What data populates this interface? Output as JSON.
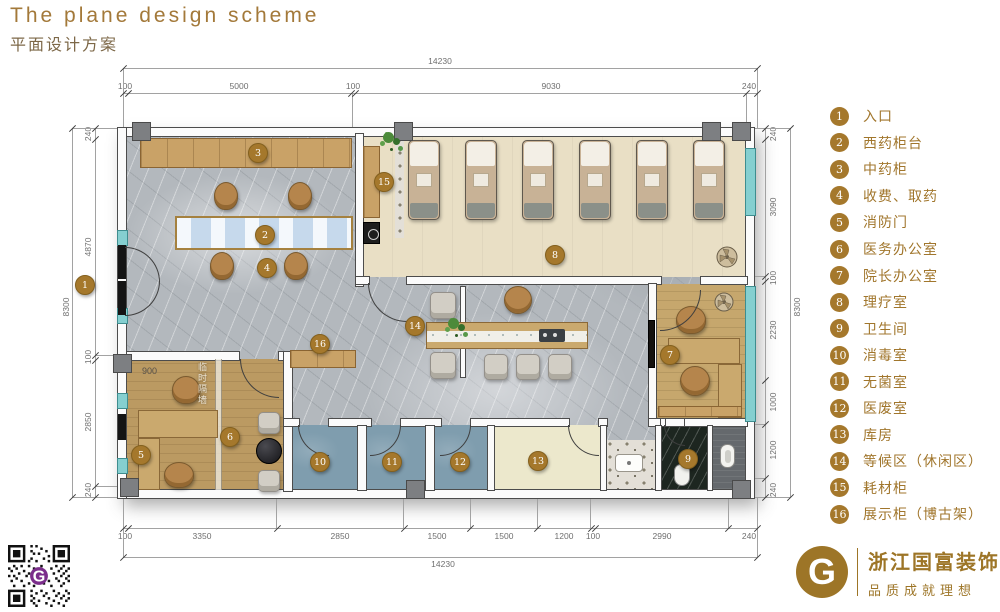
{
  "title": {
    "en": "The plane design scheme",
    "zh": "平面设计方案"
  },
  "legend": {
    "items": [
      {
        "num": "1",
        "label": "入口"
      },
      {
        "num": "2",
        "label": "西药柜台"
      },
      {
        "num": "3",
        "label": "中药柜"
      },
      {
        "num": "4",
        "label": "收费、取药"
      },
      {
        "num": "5",
        "label": "消防门"
      },
      {
        "num": "6",
        "label": "医务办公室"
      },
      {
        "num": "7",
        "label": "院长办公室"
      },
      {
        "num": "8",
        "label": "理疗室"
      },
      {
        "num": "9",
        "label": "卫生间"
      },
      {
        "num": "10",
        "label": "消毒室"
      },
      {
        "num": "11",
        "label": "无菌室"
      },
      {
        "num": "12",
        "label": "医废室"
      },
      {
        "num": "13",
        "label": "库房"
      },
      {
        "num": "14",
        "label": "等候区（休闲区）"
      },
      {
        "num": "15",
        "label": "耗材柜"
      },
      {
        "num": "16",
        "label": "展示柜（博古架）"
      }
    ]
  },
  "dims": {
    "top": {
      "overall": "14230",
      "s": [
        "100",
        "5000",
        "100",
        "9030",
        "240"
      ]
    },
    "bottom": {
      "overall": "14230",
      "s": [
        "100",
        "3350",
        "2850",
        "1500",
        "1500",
        "1200",
        "100",
        "2990",
        "240"
      ]
    },
    "left": {
      "overall": "8300",
      "s": [
        "240",
        "4870",
        "100",
        "2850",
        "240"
      ]
    },
    "right": {
      "overall": "8300",
      "s": [
        "240",
        "3090",
        "100",
        "2230",
        "1000",
        "1200",
        "240"
      ]
    }
  },
  "plan": {
    "markers": [
      "1",
      "2",
      "3",
      "4",
      "5",
      "6",
      "7",
      "8",
      "9",
      "10",
      "11",
      "12",
      "13",
      "14",
      "15",
      "16"
    ],
    "partition_width": "900",
    "partition_label": "临时隔墙"
  },
  "branding": {
    "logo_letter": "G",
    "company": "浙江国富装饰",
    "slogan": "品质成就理想"
  },
  "colors": {
    "gold": "#a5782c",
    "teal": "#85cfd0",
    "blue_room": "#7f9dae",
    "cream_room": "#ece8cc",
    "beige_room": "#e9dfc5"
  }
}
